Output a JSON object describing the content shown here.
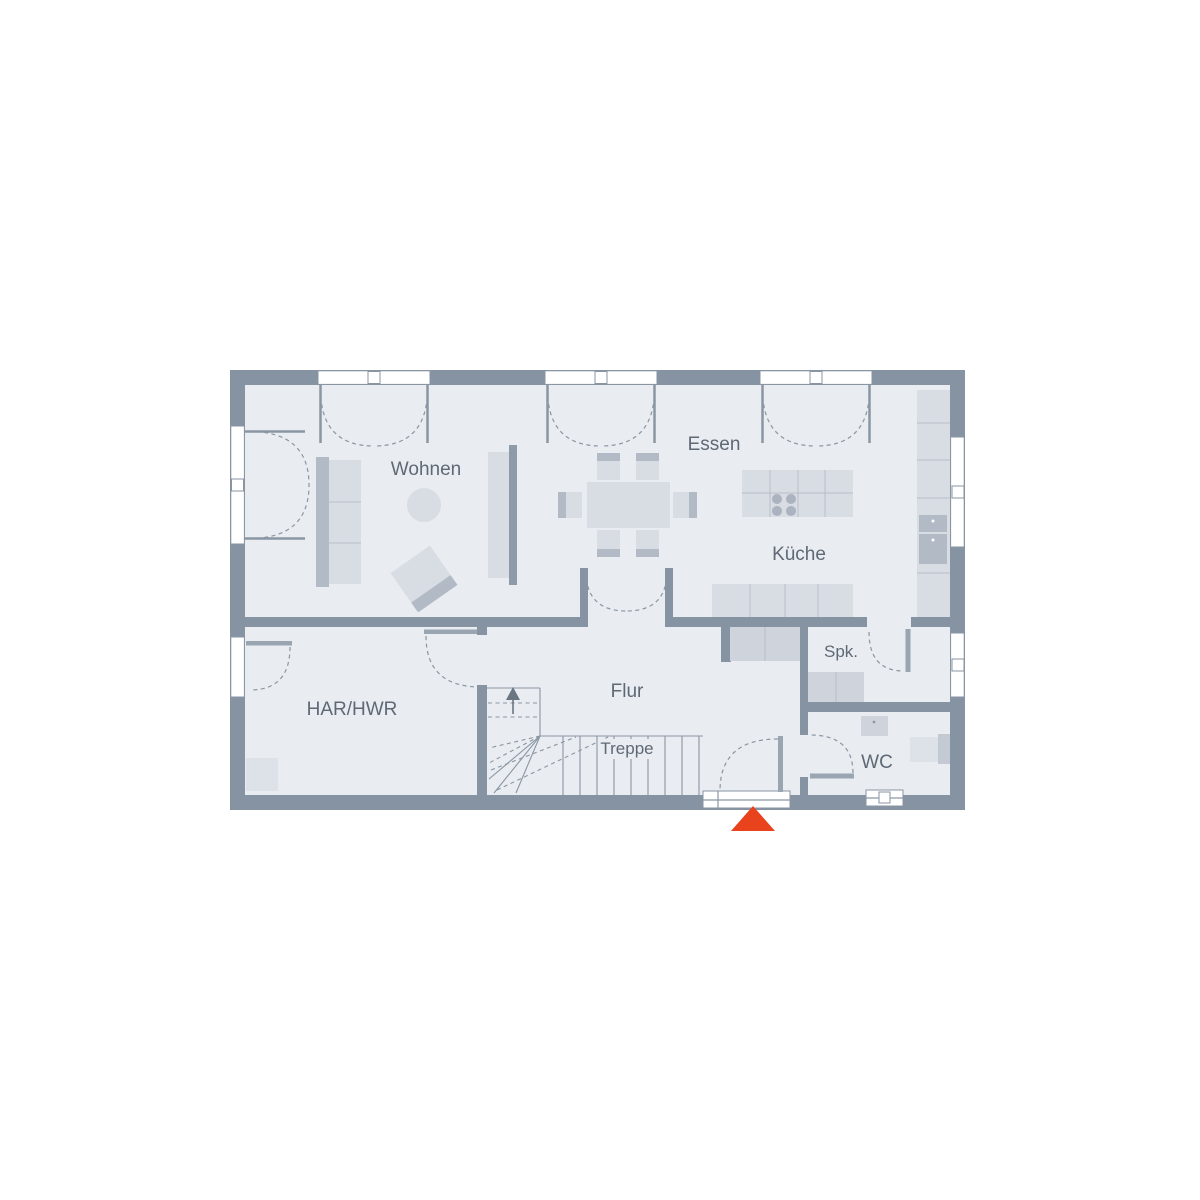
{
  "rooms": {
    "wohnen": "Wohnen",
    "essen": "Essen",
    "kueche": "Küche",
    "spk": "Spk.",
    "flur": "Flur",
    "har_hwr": "HAR/HWR",
    "treppe": "Treppe",
    "wc": "WC"
  },
  "colors": {
    "wall": "#8593a2",
    "floor": "#e9ecf1",
    "furniture": "#d8dce3",
    "furniture_mid": "#cfd4dc",
    "furniture_dark": "#b2bac5",
    "line": "#8a96a3",
    "label": "#5f6974",
    "accent": "#e8431c"
  }
}
